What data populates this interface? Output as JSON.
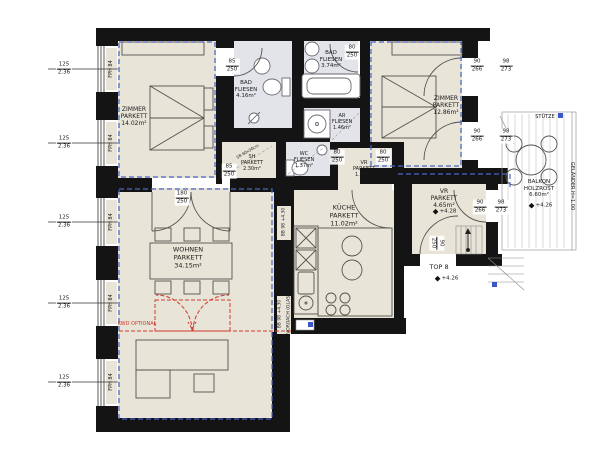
{
  "plan": {
    "colors": {
      "wall": "#141414",
      "parkett_floor": "#e8e4d7",
      "fliesen_floor": "#e2e4ea",
      "envelope_blue": "#4a63c8",
      "optional_red": "#d03a2e",
      "marker_blue": "#3a56c9"
    },
    "texts": [
      {
        "name": "room-label-zimmer-1",
        "lines": [
          "ZIMMER",
          "PARKETT",
          "14.02m²"
        ],
        "x": 134,
        "y": 117,
        "size": 6
      },
      {
        "name": "room-label-bad-1",
        "lines": [
          "BAD",
          "FLIESEN",
          "4.16m²"
        ],
        "x": 246,
        "y": 90,
        "size": 5.5
      },
      {
        "name": "room-label-bad-2",
        "lines": [
          "BAD",
          "FLIESEN",
          "3.74m²"
        ],
        "x": 331,
        "y": 60,
        "size": 5.5
      },
      {
        "name": "room-label-zimmer-2",
        "lines": [
          "ZIMMER",
          "PARKETT",
          "12.86m²"
        ],
        "x": 446,
        "y": 106,
        "size": 6
      },
      {
        "name": "room-label-ar",
        "lines": [
          "AR",
          "FLIESEN",
          "1.46m²"
        ],
        "x": 342,
        "y": 122,
        "size": 5
      },
      {
        "name": "room-label-wc",
        "lines": [
          "WC",
          "FLIESEN",
          "1.37m²"
        ],
        "x": 304,
        "y": 160,
        "size": 5
      },
      {
        "name": "room-label-sh",
        "lines": [
          "SH",
          "PARKETT",
          "2.30m²"
        ],
        "x": 252,
        "y": 163,
        "size": 5
      },
      {
        "name": "room-label-vr-klein",
        "lines": [
          "VR",
          "PARKETT",
          "1.47m²"
        ],
        "x": 364,
        "y": 169,
        "size": 5
      },
      {
        "name": "room-label-wohnen",
        "lines": [
          "WOHNEN",
          "PARKETT",
          "34.15m²"
        ],
        "x": 188,
        "y": 258,
        "size": 6.5
      },
      {
        "name": "room-label-kueche",
        "lines": [
          "KÜCHE",
          "PARKETT",
          "11.02m²"
        ],
        "x": 344,
        "y": 216,
        "size": 6.5
      },
      {
        "name": "room-label-vr-entry",
        "lines": [
          "VR",
          "PARKETT",
          "4.65m²"
        ],
        "x": 444,
        "y": 199,
        "size": 6
      },
      {
        "name": "level-marker-vr",
        "lines": [
          "+4.28"
        ],
        "x": 445,
        "y": 212,
        "size": 5.5,
        "marker": true
      },
      {
        "name": "unit-label-top8",
        "lines": [
          "TOP 8"
        ],
        "x": 439,
        "y": 268,
        "size": 6.5
      },
      {
        "name": "level-marker-top8",
        "lines": [
          "+4.26"
        ],
        "x": 447,
        "y": 279,
        "size": 5.5,
        "marker": true
      },
      {
        "name": "room-label-balkon",
        "lines": [
          "BALKON",
          "HOLZROST",
          "6.60m²"
        ],
        "x": 539,
        "y": 189,
        "size": 5.5
      },
      {
        "name": "level-marker-balkon",
        "lines": [
          "+4.26"
        ],
        "x": 541,
        "y": 206,
        "size": 5.5,
        "marker": true
      },
      {
        "name": "annotation-stuetze",
        "lines": [
          "STÜTZE"
        ],
        "x": 545,
        "y": 117,
        "size": 5
      },
      {
        "name": "annotation-gelaender",
        "lines": [
          "GELÄNDER H=1.00"
        ],
        "x": 572,
        "y": 186,
        "size": 5,
        "rotate": 90
      },
      {
        "name": "annotation-elni",
        "lines": [
          "EL.NI."
        ],
        "x": 264,
        "y": 183,
        "size": 4.5
      },
      {
        "name": "annotation-kwd-optional",
        "lines": [
          "KWD OPTIONAL"
        ],
        "x": 137,
        "y": 324,
        "size": 5,
        "color": "#d03a2e"
      },
      {
        "name": "annotation-bb-1",
        "lines": [
          "BB 98 +4.30"
        ],
        "x": 284,
        "y": 222,
        "size": 4.5,
        "rotate": -90
      },
      {
        "name": "annotation-bb-2",
        "lines": [
          "BB 98 +4.30"
        ],
        "x": 280,
        "y": 314,
        "size": 4.5,
        "rotate": -90
      },
      {
        "name": "annotation-vordach",
        "lines": [
          "VORDACH (GLAS)"
        ],
        "x": 289,
        "y": 314,
        "size": 4.5,
        "rotate": -90
      },
      {
        "name": "annotation-sb-schacht",
        "lines": [
          "SB 60x30cm"
        ],
        "x": 248,
        "y": 152,
        "size": 4,
        "rotate": -30
      },
      {
        "name": "window-type-label-1",
        "lines": [
          "FPH 84"
        ],
        "x": 111,
        "y": 69,
        "size": 5,
        "rotate": -90
      },
      {
        "name": "window-type-label-2",
        "lines": [
          "FPH 84"
        ],
        "x": 111,
        "y": 143,
        "size": 5,
        "rotate": -90
      },
      {
        "name": "window-type-label-3",
        "lines": [
          "FPH 84"
        ],
        "x": 111,
        "y": 222,
        "size": 5,
        "rotate": -90
      },
      {
        "name": "window-type-label-4",
        "lines": [
          "FPH 84"
        ],
        "x": 111,
        "y": 303,
        "size": 5,
        "rotate": -90
      },
      {
        "name": "window-type-label-5",
        "lines": [
          "FPH 84"
        ],
        "x": 111,
        "y": 382,
        "size": 5,
        "rotate": -90
      }
    ],
    "dims": [
      {
        "name": "window-dim-1",
        "top": "125",
        "bottom": "2.36",
        "x": 64,
        "y": 69
      },
      {
        "name": "window-dim-2",
        "top": "125",
        "bottom": "2.36",
        "x": 64,
        "y": 143
      },
      {
        "name": "window-dim-3",
        "top": "125",
        "bottom": "2.36",
        "x": 64,
        "y": 222
      },
      {
        "name": "window-dim-4",
        "top": "125",
        "bottom": "2.36",
        "x": 64,
        "y": 303
      },
      {
        "name": "window-dim-5",
        "top": "125",
        "bottom": "2.36",
        "x": 64,
        "y": 382
      },
      {
        "name": "door-dim-bad1",
        "top": "85",
        "bottom": "250",
        "x": 232,
        "y": 66
      },
      {
        "name": "door-dim-bad2",
        "top": "80",
        "bottom": "250",
        "x": 352,
        "y": 52
      },
      {
        "name": "door-dim-balkon1-a",
        "top": "90",
        "bottom": "266",
        "x": 477,
        "y": 66
      },
      {
        "name": "door-dim-balkon1-b",
        "top": "98",
        "bottom": "273",
        "x": 506,
        "y": 66
      },
      {
        "name": "door-dim-balkon2-a",
        "top": "90",
        "bottom": "266",
        "x": 477,
        "y": 136
      },
      {
        "name": "door-dim-balkon2-b",
        "top": "98",
        "bottom": "273",
        "x": 506,
        "y": 136
      },
      {
        "name": "door-dim-sh",
        "top": "85",
        "bottom": "250",
        "x": 229,
        "y": 171
      },
      {
        "name": "door-dim-vr-left",
        "top": "80",
        "bottom": "250",
        "x": 337,
        "y": 157
      },
      {
        "name": "door-dim-vr-right",
        "top": "80",
        "bottom": "250",
        "x": 383,
        "y": 157
      },
      {
        "name": "door-dim-wohnen",
        "top": "180",
        "bottom": "250",
        "x": 182,
        "y": 198
      },
      {
        "name": "door-dim-entry",
        "top": "90",
        "bottom": "250",
        "x": 437,
        "y": 243,
        "rotate": 90
      },
      {
        "name": "door-dim-vrentry-a",
        "top": "90",
        "bottom": "266",
        "x": 480,
        "y": 207
      },
      {
        "name": "door-dim-vrentry-b",
        "top": "98",
        "bottom": "273",
        "x": 501,
        "y": 207
      }
    ]
  }
}
